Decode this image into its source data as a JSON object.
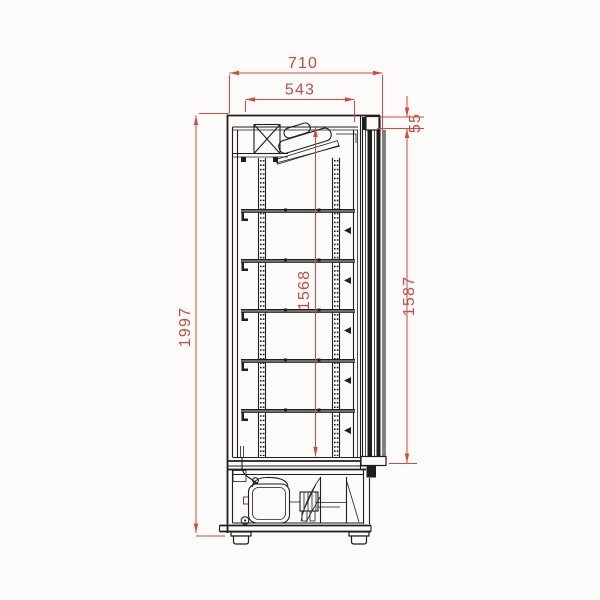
{
  "drawing": {
    "type": "technical-dimension-drawing",
    "subject": "upright display cooler, side section view",
    "units": "mm",
    "dimensions": {
      "overall_depth": "710",
      "inner_depth": "543",
      "top_frame_height": "55",
      "inner_height": "1568",
      "door_height": "1587",
      "overall_height": "1997"
    },
    "colors": {
      "line": "#1e1e1c",
      "dimension": "#d5483c",
      "background": "#fcfbfa"
    }
  }
}
